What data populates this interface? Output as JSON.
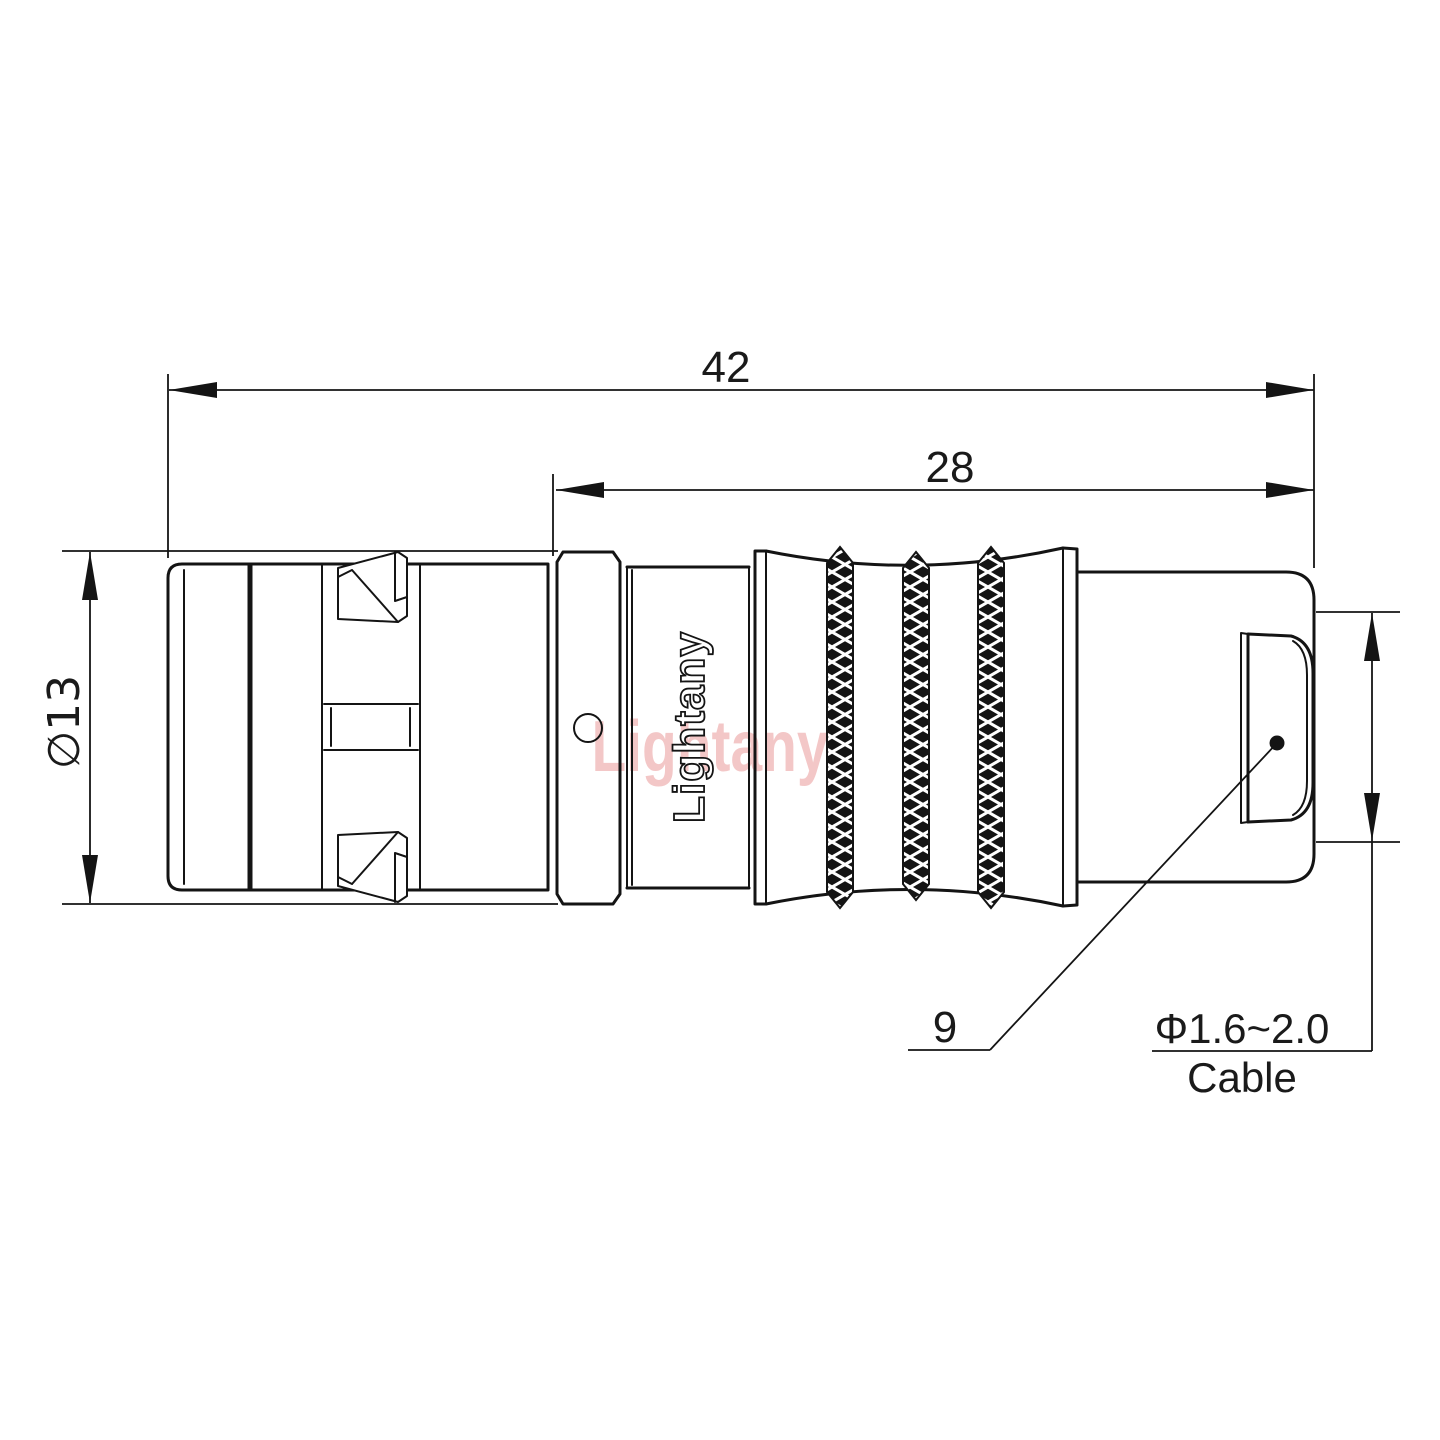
{
  "dimensions": {
    "total_length": "42",
    "rear_section_length": "28",
    "body_diameter": "∅13",
    "shell_size": "9",
    "cable_range": "Φ1.6~2.0",
    "cable_label": "Cable"
  },
  "branding": {
    "engraving": "Lightany",
    "watermark": "Lightany"
  },
  "colors": {
    "line": "#141414",
    "watermark_pink": "#e89090",
    "paper": "#ffffff"
  }
}
